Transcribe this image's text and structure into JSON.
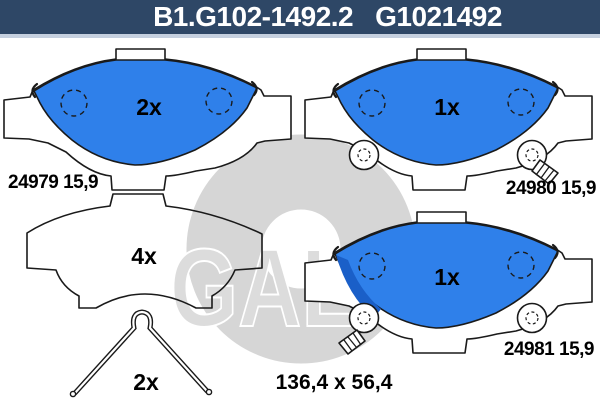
{
  "header": {
    "catalog_number": "B1.G102-1492.2",
    "oe_reference": "G1021492"
  },
  "watermark": {
    "brand": "GALFER"
  },
  "parts": {
    "pad_top_left": {
      "quantity": "2x",
      "part_number": "24979 15,9"
    },
    "pad_top_right": {
      "quantity": "1x",
      "part_number": "24980 15,9"
    },
    "shim": {
      "quantity": "4x"
    },
    "pad_bottom_right": {
      "quantity": "1x",
      "part_number": "24981 15,9"
    },
    "spring_clip": {
      "quantity": "2x"
    }
  },
  "dimensions": {
    "pad_size": "136,4 x 56,4"
  },
  "colors": {
    "header_bg": "#2e4766",
    "pad_fill": "#2f80ea",
    "pad_fill_dark": "#1a5fc8",
    "watermark": "#d6d6d6"
  }
}
